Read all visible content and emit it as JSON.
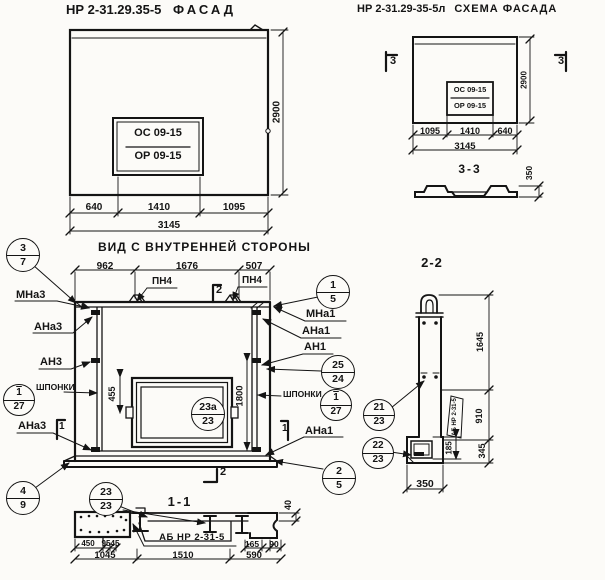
{
  "facade": {
    "code": "НР 2-31.29.35-5",
    "name": "ФАСАД",
    "window": {
      "line1": "ОС 09-15",
      "line2": "ОР 09-15"
    },
    "dim_seg1": "640",
    "dim_seg2": "1410",
    "dim_seg3": "1095",
    "dim_total": "3145",
    "dim_height": "2900"
  },
  "scheme": {
    "code": "НР 2-31.29-35-5л",
    "name": "СХЕМА ФАСАДА",
    "window": {
      "line1": "ОС 09-15",
      "line2": "ОР 09-15"
    },
    "dim_seg1": "1095",
    "dim_seg2": "1410",
    "dim_seg3": "640",
    "dim_total": "3145",
    "dim_height": "2900",
    "marker_left": "3",
    "marker_right": "3"
  },
  "section33": {
    "title": "3-3",
    "dim_thickness": "350"
  },
  "inner": {
    "title": "ВИД С ВНУТРЕННЕЙ СТОРОНЫ",
    "dim_seg1": "962",
    "dim_seg2": "1676",
    "dim_seg3": "507",
    "dim_window": "455",
    "dim_opening": "1800",
    "loop_label1": "ПН4",
    "loop_label2": "ПН4",
    "marker_top": "2",
    "marker_bottom": "2",
    "flag_left": "1",
    "flag_right": "1",
    "left_labels": {
      "l1": "МНа3",
      "l2": "АНа3",
      "l3": "АН3",
      "l4": "ШПОНКИ",
      "l5": "АНа3"
    },
    "right_labels": {
      "r1": "МНа1",
      "r2": "АНа1",
      "r3": "АН1",
      "r4": "ШПОНКИ",
      "r5": "АНа1"
    }
  },
  "callouts": {
    "c37": {
      "top": "3",
      "bottom": "7"
    },
    "c15": {
      "top": "1",
      "bottom": "5"
    },
    "c2524": {
      "top": "25",
      "bottom": "24"
    },
    "c127l": {
      "top": "1",
      "bottom": "27"
    },
    "c127r": {
      "top": "1",
      "bottom": "27"
    },
    "c23a": {
      "top": "23а",
      "bottom": "23"
    },
    "c49": {
      "top": "4",
      "bottom": "9"
    },
    "c2323": {
      "top": "23",
      "bottom": "23"
    },
    "c25": {
      "top": "2",
      "bottom": "5"
    },
    "c2123": {
      "top": "21",
      "bottom": "23"
    },
    "c2223": {
      "top": "22",
      "bottom": "23"
    }
  },
  "section11": {
    "title": "1-1",
    "beam_label": "АБ НР 2-31-5",
    "d450": "450",
    "d95": "95",
    "d45": "45",
    "d1045": "1045",
    "d1510": "1510",
    "d165": "165",
    "d90": "90",
    "d590": "590",
    "d40": "40"
  },
  "section22": {
    "title": "2-2",
    "beam_label": "АБ НР 2-31-5",
    "d1645": "1645",
    "d910": "910",
    "d345": "345",
    "d185": "185",
    "d350": "350"
  }
}
